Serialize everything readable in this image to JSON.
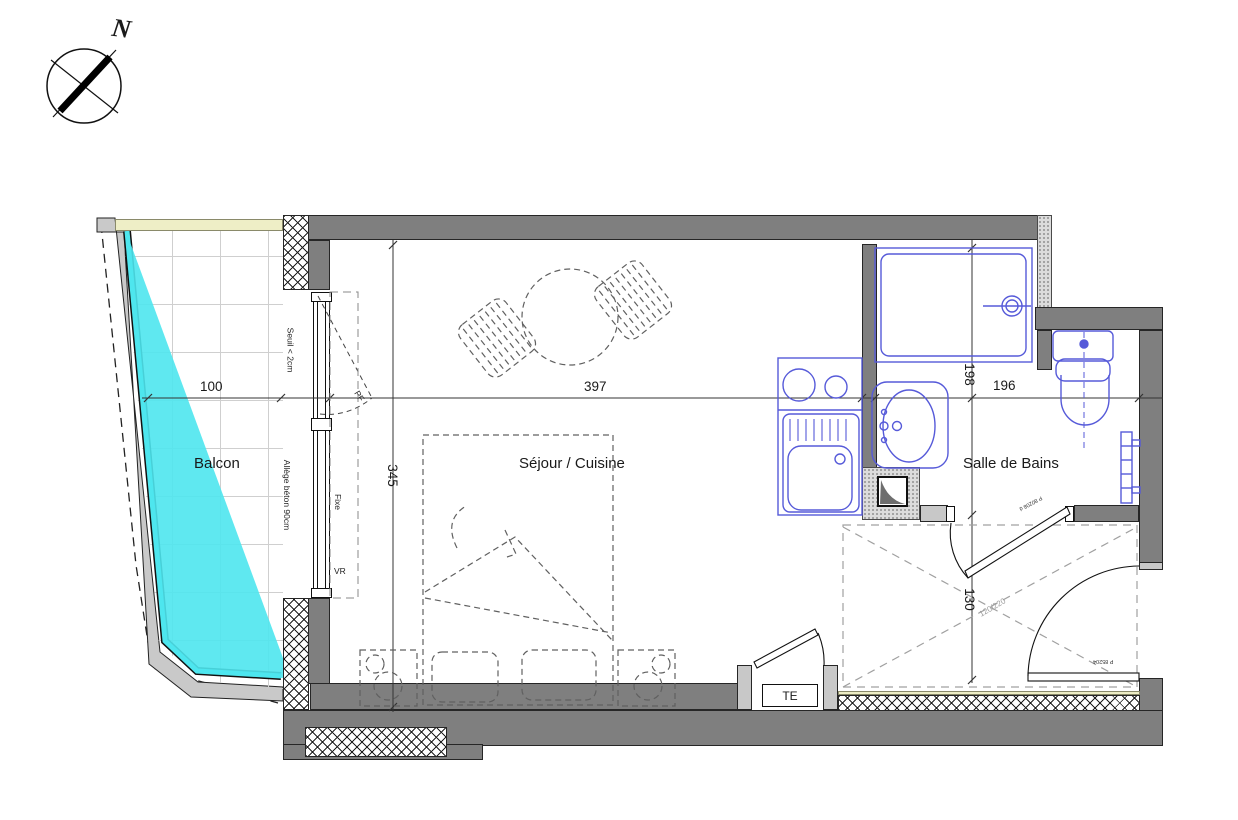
{
  "compass": {
    "north_label": "N"
  },
  "rooms": [
    {
      "name": "Balcon"
    },
    {
      "name": "Séjour / Cuisine"
    },
    {
      "name": "Salle de Bains"
    }
  ],
  "dimensions": {
    "balcony_width": "100",
    "sejour_width": "397",
    "sejour_depth": "345",
    "bath_upper": "198",
    "bath_width": "196",
    "hall_depth": "130"
  },
  "annotations": {
    "threshold": "Seuil < 2cm",
    "sill": "Allège béton 90cm",
    "fixed_pane": "Fixe",
    "roller_shutter": "VR",
    "french_window": "PF",
    "electrical_panel": "TE",
    "closet_size": "120/220",
    "bath_door_ref": "P 80208 d",
    "entry_door_ref": "P 85204"
  },
  "colors": {
    "wall_gray": "#7f7f7f",
    "concrete_gray": "#c9c9c9",
    "fixture_blue": "#565ad9",
    "glass_cyan": "#4ee6ee",
    "insulation_yellow": "#eeeec6",
    "furniture_dash": "#606060"
  }
}
